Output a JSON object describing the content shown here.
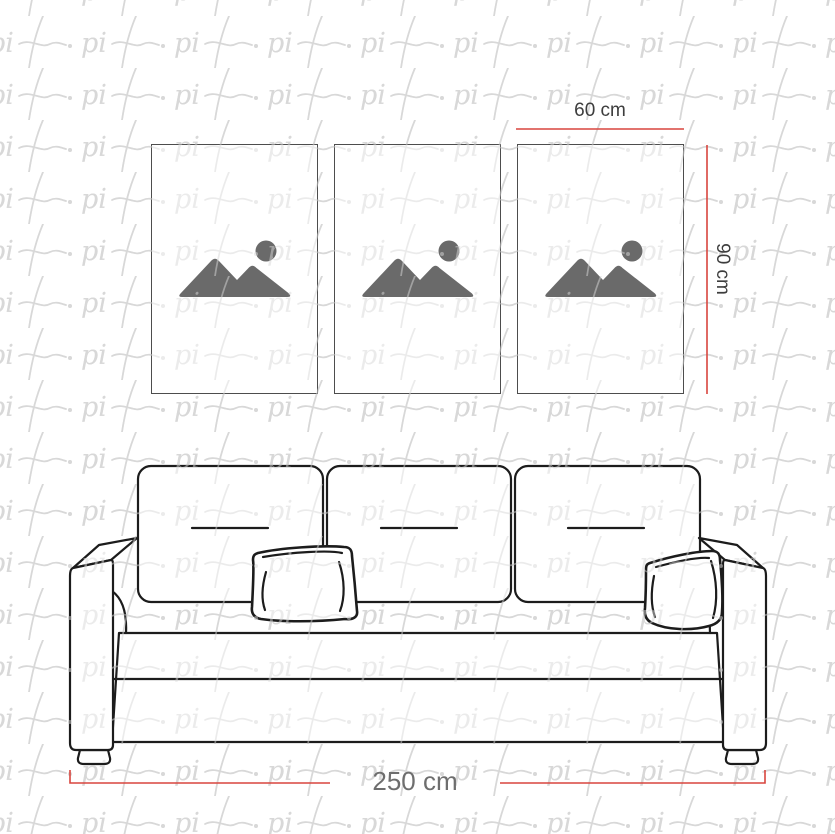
{
  "scene": {
    "description": "Wall art size guide: three vertical canvases above a sofa sketch",
    "colors": {
      "watermark": "#d8d8d8",
      "outline": "#1c1c1c",
      "dimension_red": "#d8453e",
      "placeholder_icon": "#6a6a6a",
      "frame_border": "#4d4d4d",
      "label_dark": "#3d3d3d",
      "label_mid": "#6e6e6e"
    }
  },
  "watermark": {
    "text": "pi",
    "tail": ".",
    "repeat": "tiled"
  },
  "labels": {
    "art_width": "60 cm",
    "art_height": "90 cm",
    "sofa_width": "250 cm"
  },
  "frames": [
    {
      "id": "frame-1",
      "icon": "image-placeholder-icon"
    },
    {
      "id": "frame-2",
      "icon": "image-placeholder-icon"
    },
    {
      "id": "frame-3",
      "icon": "image-placeholder-icon"
    }
  ]
}
